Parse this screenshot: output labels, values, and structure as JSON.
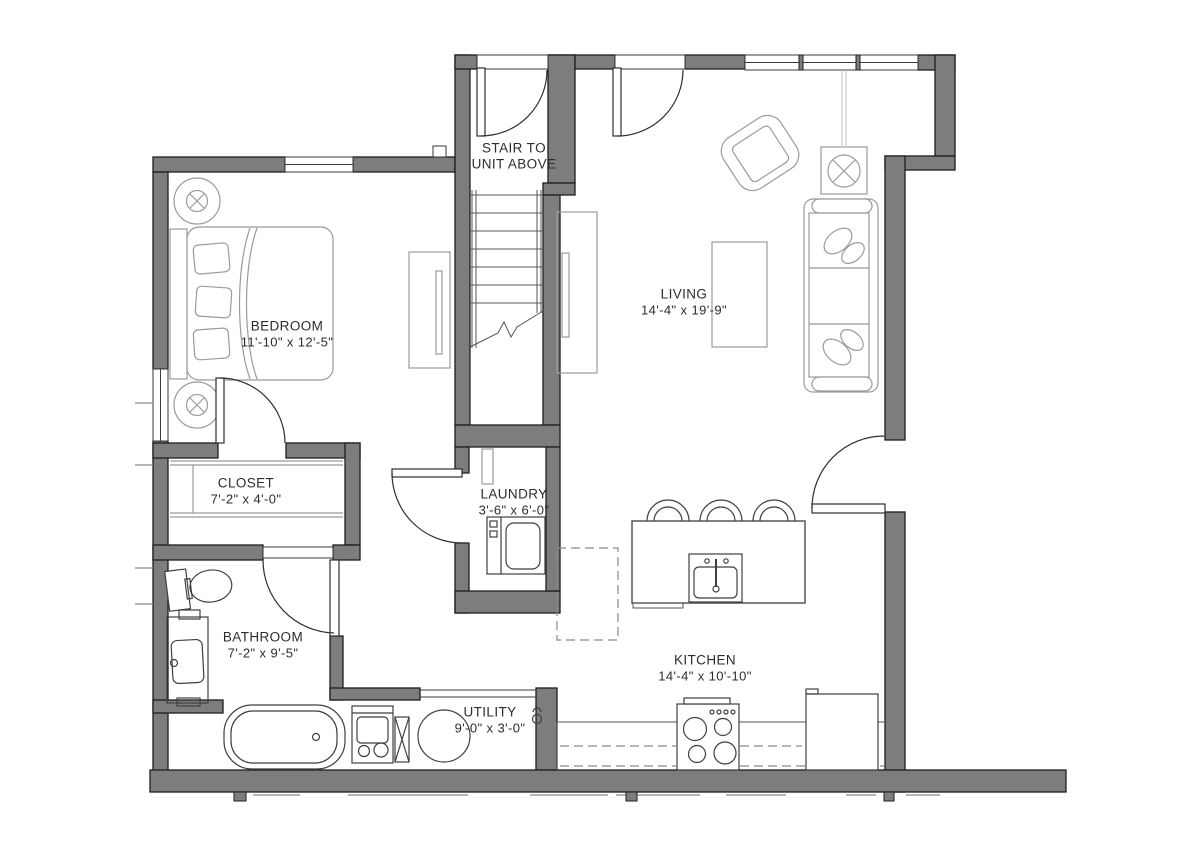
{
  "plan": {
    "rooms": [
      {
        "id": "stair",
        "name": "STAIR TO UNIT ABOVE",
        "dimensions": ""
      },
      {
        "id": "bedroom",
        "name": "BEDROOM",
        "dimensions": "11'-10\" x 12'-5\""
      },
      {
        "id": "living",
        "name": "LIVING",
        "dimensions": "14'-4\" x 19'-9\""
      },
      {
        "id": "closet",
        "name": "CLOSET",
        "dimensions": "7'-2\" x 4'-0\""
      },
      {
        "id": "laundry",
        "name": "LAUNDRY",
        "dimensions": "3'-6\" x 6'-0\""
      },
      {
        "id": "bathroom",
        "name": "BATHROOM",
        "dimensions": "7'-2\" x 9'-5\""
      },
      {
        "id": "utility",
        "name": "UTILITY",
        "dimensions": "9'-0\" x 3'-0\""
      },
      {
        "id": "kitchen",
        "name": "KITCHEN",
        "dimensions": "14'-4\" x 10'-10\""
      }
    ],
    "colors": {
      "wall_fill": "#7d7d7d",
      "wall_outline": "#1e1e1e",
      "furniture_line": "#9b9b9b",
      "fixture_line": "#3f3f3f",
      "label_text": "#2d2d2d",
      "background": "#ffffff"
    }
  }
}
